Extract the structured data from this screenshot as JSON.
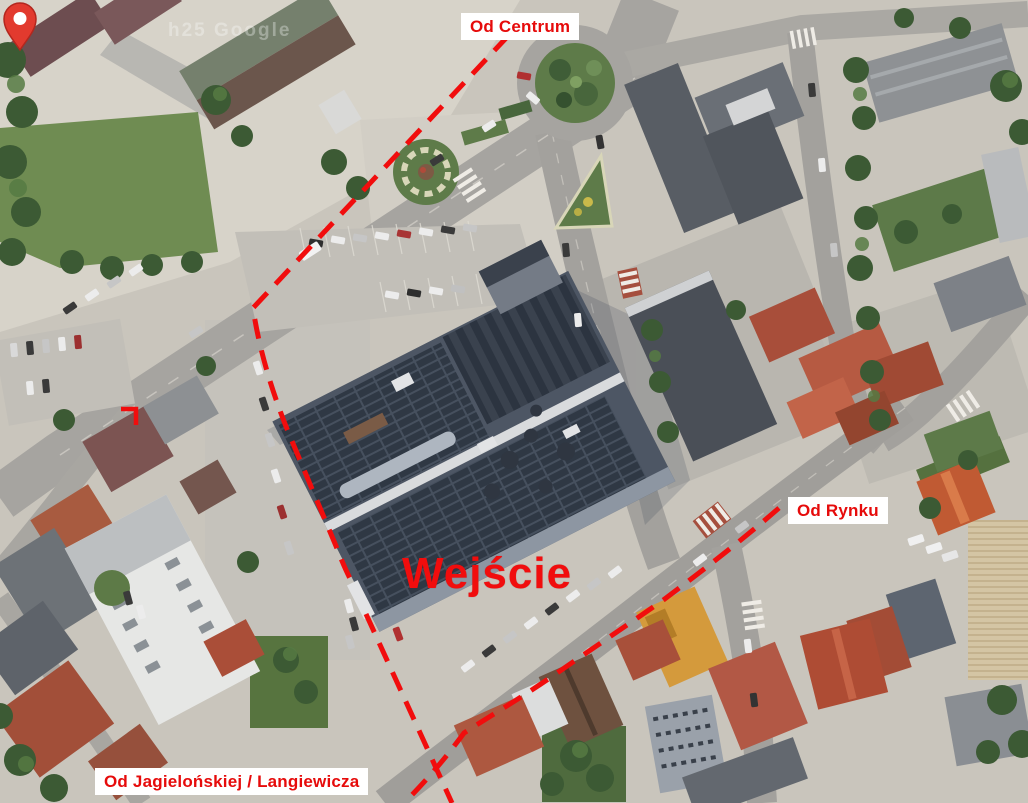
{
  "map_overlay": {
    "entrance": {
      "label": "Wejście",
      "marker_icon": "map-pin-icon"
    },
    "direction_labels": [
      {
        "id": "od-centrum",
        "text": "Od Centrum"
      },
      {
        "id": "od-rynku",
        "text": "Od Rynku"
      },
      {
        "id": "od-jagielonskiej-langiewicza",
        "text": "Od Jagielońskiej / Langiewicza"
      }
    ],
    "routes": {
      "od_centrum": {
        "d": "M508,36 L253,308 C259,349 272,392 289,434 L336,546 C343,564 349,578 355,587"
      },
      "od_rynku": {
        "d": "M779,508 C741,541 702,571 662,601 L557,673 C521,698 490,716 464,733 C447,756 429,778 404,803"
      },
      "od_jagielonskiej": {
        "d": "M366,614 L452,803"
      }
    },
    "corner_marker": {
      "d": "M121,409 L136,409 L136,425"
    },
    "colors": {
      "route_red": "#f10d0d",
      "label_text_red": "#e60b0b",
      "label_bg": "#ffffff",
      "pin_red": "#e23a2e"
    },
    "watermark": "h25 Google"
  }
}
